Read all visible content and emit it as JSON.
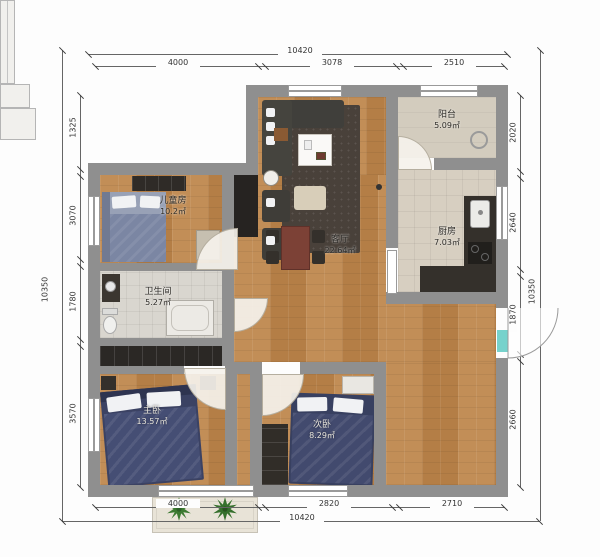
{
  "rooms": [
    {
      "name": "儿童房",
      "area": "10.2㎡"
    },
    {
      "name": "卫生间",
      "area": "5.27㎡"
    },
    {
      "name": "客厅",
      "area": "22.64㎡"
    },
    {
      "name": "厨房",
      "area": "7.03㎡"
    },
    {
      "name": "阳台",
      "area": "5.09㎡"
    },
    {
      "name": "主卧",
      "area": "13.57㎡"
    },
    {
      "name": "次卧",
      "area": "8.29㎡"
    }
  ],
  "dims": {
    "top": {
      "overall": "10420",
      "segments": [
        "4000",
        "3078",
        "2510"
      ]
    },
    "bottom": {
      "overall": "10420",
      "segments": [
        "4000",
        "2820",
        "2710"
      ]
    },
    "left": {
      "overall": "10350",
      "segments": [
        "1325",
        "3070",
        "1780",
        "3570"
      ]
    },
    "right": {
      "overall": "10350",
      "segments": [
        "2020",
        "2640",
        "1870",
        "2660"
      ]
    }
  },
  "colors": {
    "wall": "#8f8f8f",
    "wood_floor": "#bf8a52",
    "kitchen_tile": "#d7cfc1",
    "bath_tile": "#d9d6cf",
    "rug": "#49413a",
    "bed": "#3e4565",
    "accent_cyan": "#76d2cc",
    "plant_green": "#3c7a31"
  }
}
